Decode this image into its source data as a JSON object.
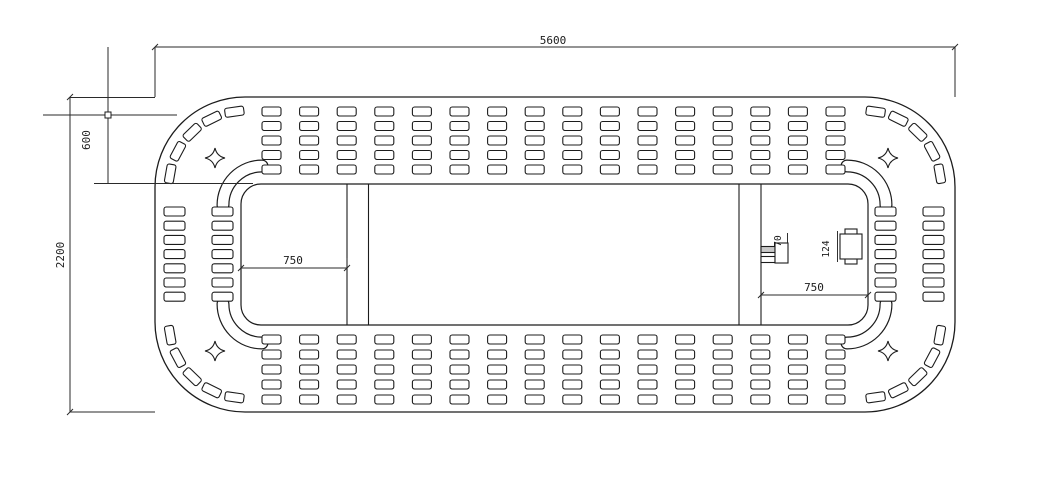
{
  "page": {
    "background": "#ffffff",
    "line_color": "#1c1c1c",
    "dim_color": "#2a2a2a",
    "fixture_fill": "#c9c9c9"
  },
  "drawing": {
    "type": "cad-plan-stadium-table",
    "dimensions": {
      "overall_width": "5600",
      "overall_height": "2200",
      "ring_depth": "600",
      "left_bay_width": "750",
      "right_bay_width": "750",
      "left_fixture_height": "70",
      "right_fixture_height": "124"
    },
    "seating": {
      "top_band": {
        "rows": 5,
        "cols": 16
      },
      "bottom_band": {
        "rows": 5,
        "cols": 16
      },
      "left_side": {
        "rows": 7,
        "cols": 2
      },
      "right_side": {
        "rows": 7,
        "cols": 2
      },
      "corner_units_per_corner": 5,
      "corner_count": 4
    }
  }
}
